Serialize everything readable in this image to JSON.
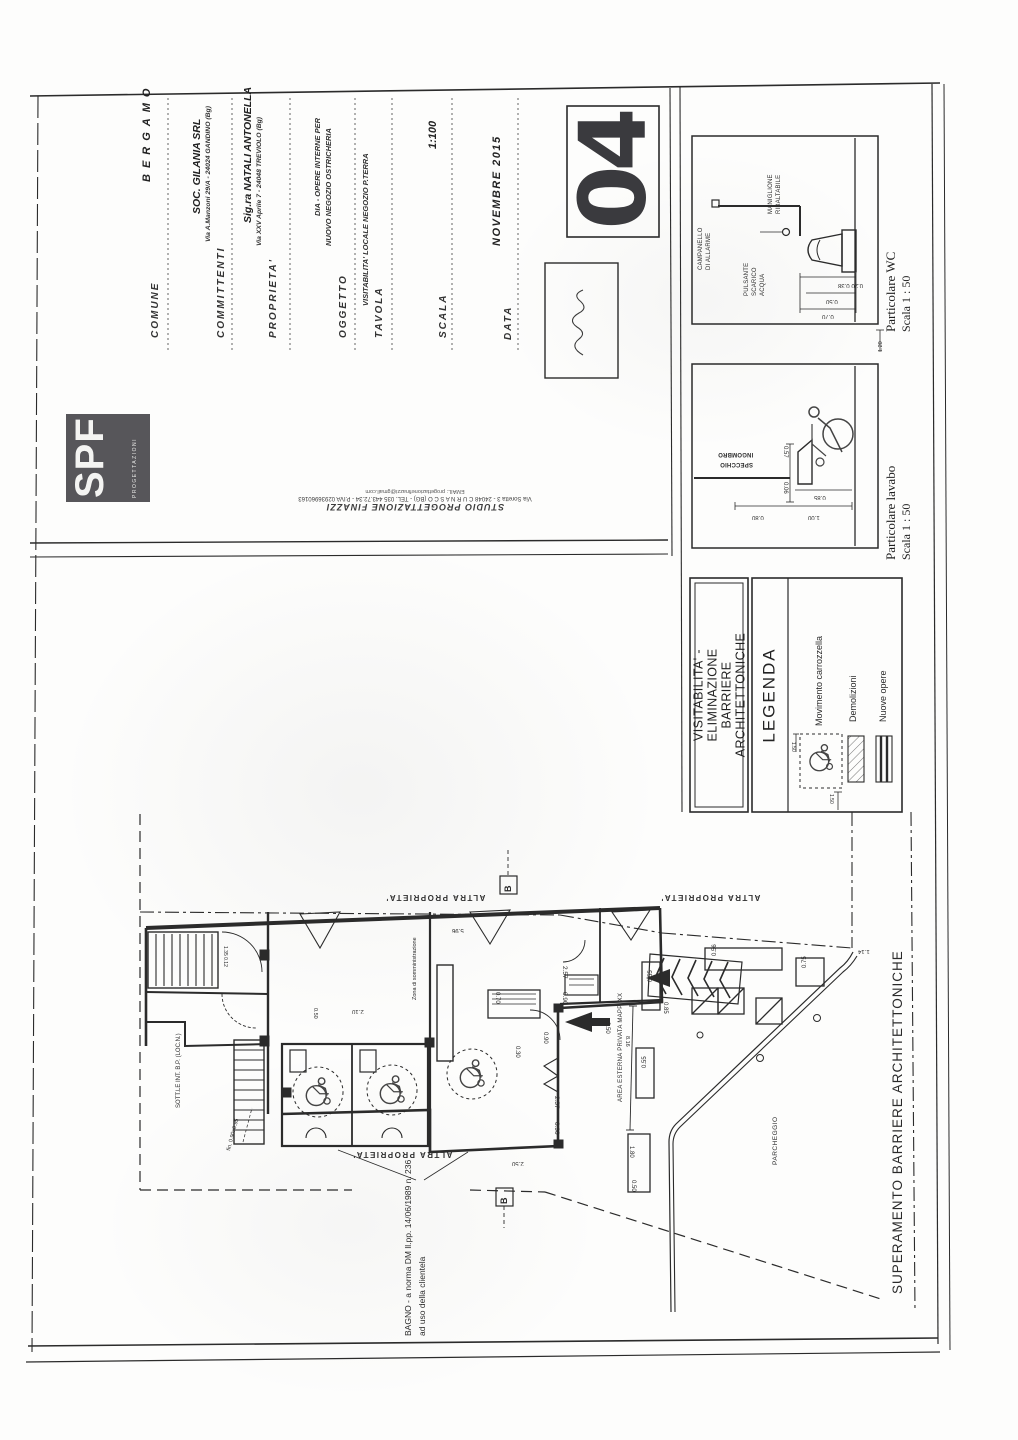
{
  "title_block": {
    "comune_label": "COMUNE",
    "comune_value": "BERGAMO",
    "committenti_label": "COMMITTENTI",
    "committenti_value": "SOC. GILANIA SRL",
    "committenti_address": "Via A.Manzoni 29/A - 24024 GANDINO (Bg)",
    "proprieta_label": "PROPRIETA'",
    "proprieta_value": "Sig.ra NATALI ANTONELLA",
    "proprieta_address": "Via XXV Aprile 7 - 24048 TREVIOLO (Bg)",
    "oggetto_label": "OGGETTO",
    "oggetto_line1": "DIA - OPERE INTERNE PER",
    "oggetto_line2": "NUOVO NEGOZIO OSTRICHERIA",
    "tavola_label": "TAVOLA",
    "tavola_value": "VISITABILITA' LOCALE NEGOZIO P.TERRA",
    "scala_label": "SCALA",
    "scala_value": "1:100",
    "data_label": "DATA",
    "data_value": "NOVEMBRE 2015",
    "sheet_number": "04"
  },
  "logo": {
    "text": "SPF",
    "subtext": "PROGETTAZIONI"
  },
  "studio": {
    "name": "STUDIO PROGETTAZIONE FINAZZI",
    "address": "Via Soretta 3 - 24048 C U R N A S C O (BG) - TEL. 035 443.72.34 - P.IVA 02936960163",
    "email": "EMAIL: progettazionefinazzi@gmail.com"
  },
  "detail_wc": {
    "caption": "Particolare WC",
    "scale": "Scala 1 : 50",
    "label_campanello_1": "CAMPANELLO",
    "label_campanello_2": "DI ALLARME",
    "label_pulsante_1": "PULSANTE",
    "label_pulsante_2": "SCARICO",
    "label_pulsante_3": "ACQUA",
    "label_maniglione_1": "MANIGLIONE",
    "label_maniglione_2": "RIBALTABILE",
    "dims": [
      {
        "t": "0.20 0.38",
        "x": 838,
        "y": 282,
        "r": 180,
        "fs": 6
      },
      {
        "t": "0.50",
        "x": 826,
        "y": 298,
        "r": 180,
        "fs": 6
      },
      {
        "t": "0.70",
        "x": 822,
        "y": 313,
        "r": 180,
        "fs": 6
      },
      {
        "t": "1.20",
        "x": 878,
        "y": 352,
        "r": -90,
        "fs": 5.5
      }
    ]
  },
  "detail_lavabo": {
    "caption": "Particolare lavabo",
    "scale": "Scala 1 : 50",
    "label_ingombro_1": "INGOMBRO",
    "label_ingombro_2": "SPECCHIO",
    "dims": [
      {
        "t": "0.57",
        "x": 788,
        "y": 446,
        "r": 90,
        "fs": 6
      },
      {
        "t": "0.06",
        "x": 788,
        "y": 482,
        "r": 90,
        "fs": 6
      },
      {
        "t": "0.85",
        "x": 814,
        "y": 494,
        "r": 180,
        "fs": 6
      },
      {
        "t": "0.80",
        "x": 752,
        "y": 514,
        "r": 180,
        "fs": 6
      },
      {
        "t": "1.00",
        "x": 808,
        "y": 514,
        "r": 180,
        "fs": 6
      }
    ]
  },
  "header_box": {
    "line1": "VISITABILITA'  -  ELIMINAZIONE",
    "line2": "BARRIERE  ARCHITETTONICHE"
  },
  "legend": {
    "title": "LEGENDA",
    "item1": "Movimento carrozzella",
    "item2": "Demolizioni",
    "item3": "Nuove opere",
    "dims": [
      {
        "t": "1.50",
        "x": 796,
        "y": 742,
        "r": 90,
        "fs": 5
      },
      {
        "t": "1.50",
        "x": 834,
        "y": 794,
        "r": 90,
        "fs": 5
      }
    ]
  },
  "plan": {
    "altra_proprieta": "ALTRA PROPRIETA'",
    "area_esterna": "AREA ESTERNA PRIVATA MAPP. XX",
    "zona": "Zona di somministrazione",
    "sottostante": "SOTT.LE INT. B.P. (LOC.N.)",
    "parcheggio": "PARCHEGGIO",
    "superamento": "SUPERAMENTO  BARRIERE  ARCHITETTONICHE",
    "bagno_line1": "BAGNO - a norma DM ll.pp. 14/06/1989 n. 236",
    "bagno_line2": "ad uso della clientela",
    "fin_note": "fin. 0.90x0.95",
    "section_marker": "B",
    "dims": [
      {
        "t": "5.96",
        "x": 452,
        "y": 927,
        "r": 180,
        "fs": 6
      },
      {
        "t": "0.70",
        "x": 500,
        "y": 992,
        "r": 90,
        "fs": 6
      },
      {
        "t": "2.57",
        "x": 568,
        "y": 966,
        "r": 90,
        "fs": 6.5
      },
      {
        "t": "0.90",
        "x": 568,
        "y": 992,
        "r": 90,
        "fs": 6.5
      },
      {
        "t": "2.57",
        "x": 560,
        "y": 1096,
        "r": 90,
        "fs": 6.5
      },
      {
        "t": "0.90",
        "x": 560,
        "y": 1122,
        "r": 90,
        "fs": 6.5
      },
      {
        "t": "0.30",
        "x": 520,
        "y": 1046,
        "r": 90,
        "fs": 6
      },
      {
        "t": "2.50",
        "x": 610,
        "y": 1022,
        "r": 90,
        "fs": 6
      },
      {
        "t": "0.85",
        "x": 668,
        "y": 1002,
        "r": 90,
        "fs": 6
      },
      {
        "t": "0.56",
        "x": 712,
        "y": 956,
        "r": -90,
        "fs": 6
      },
      {
        "t": "0.75",
        "x": 802,
        "y": 968,
        "r": -90,
        "fs": 6
      },
      {
        "t": "0.55",
        "x": 648,
        "y": 982,
        "r": -90,
        "fs": 6
      },
      {
        "t": "0.55",
        "x": 642,
        "y": 1068,
        "r": -90,
        "fs": 6
      },
      {
        "t": "1.80",
        "x": 634,
        "y": 1146,
        "r": 90,
        "fs": 6
      },
      {
        "t": "0.50",
        "x": 636,
        "y": 1180,
        "r": 90,
        "fs": 6
      },
      {
        "t": "1.14",
        "x": 858,
        "y": 948,
        "r": 180,
        "fs": 6
      },
      {
        "t": "8.16",
        "x": 630,
        "y": 1036,
        "r": 90,
        "fs": 5.5
      },
      {
        "t": "2.10",
        "x": 352,
        "y": 1008,
        "r": 180,
        "fs": 6
      },
      {
        "t": "0.50",
        "x": 318,
        "y": 1008,
        "r": 90,
        "fs": 5.5
      },
      {
        "t": "1.35 0.12",
        "x": 228,
        "y": 946,
        "r": 90,
        "fs": 5
      },
      {
        "t": "2.50",
        "x": 512,
        "y": 1160,
        "r": 180,
        "fs": 6
      },
      {
        "t": "0.90",
        "x": 548,
        "y": 1032,
        "r": 90,
        "fs": 6
      }
    ]
  },
  "colors": {
    "ink": "#2b2b2b",
    "logo_gray": "#57565a",
    "number_gray": "#3a3a3e"
  }
}
